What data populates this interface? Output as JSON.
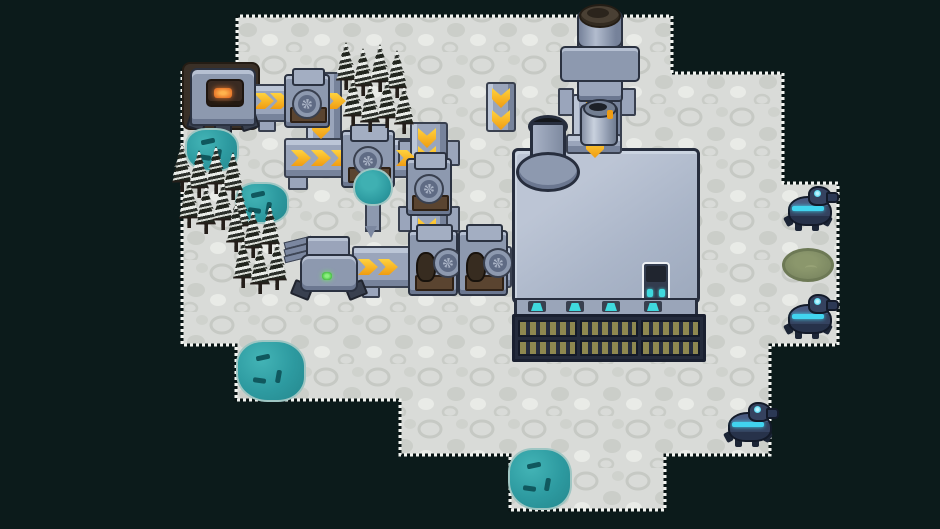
{
  "meta": {
    "scene": "top-down pixel-art factory colony on snowy rock island",
    "resolution": "940x529"
  },
  "palette": {
    "bg": "#0c1b1b",
    "ground": "#d9dbd8",
    "ground_stone": "#c6c9c4",
    "belt": "#9aa5bb",
    "belt_light": "#bcc6d7",
    "belt_shadow": "#77839b",
    "belt_dark": "#39404f",
    "arrow": "#f09c12",
    "arrow_light": "#ffd23e",
    "machine": "#8d99af",
    "machine_light": "#b6c0d2",
    "machine_dark": "#2b3241",
    "mount": "#5a4430",
    "mount_dark": "#2f2115",
    "fire": "#e8772a",
    "fire_light": "#ffb34d",
    "ore": "#2d9aa0",
    "ore_dark": "#10585e",
    "tree": "#22261f",
    "snow": "#e9ece8",
    "roof": "#aab5c8",
    "roof_dark": "#272e3e",
    "strip": "#9aa5b9",
    "slat": "#8e8850",
    "frame": "#242b3c",
    "teal": "#3fd9de",
    "robot": "#35425f",
    "robot_accent": "#41d4ef",
    "pond": "#7c8862",
    "pond_dark": "#6d7955",
    "dirt": "#3a3027",
    "dirt_dark": "#241c14"
  },
  "terrain": {
    "path": "M237,16 H672 V73 H783 V183 H838 V345 H770 V455 H665 V510 H510 V455 H400 V400 H236 V345 H182 V70 H237 Z"
  },
  "dirt_patches": [
    {
      "x": 182,
      "y": 62,
      "w": 78,
      "h": 68
    }
  ],
  "belts": [
    {
      "x": 248,
      "y": 84,
      "w": 94,
      "h": 38,
      "dir": "h"
    },
    {
      "x": 306,
      "y": 72,
      "w": 36,
      "h": 70,
      "dir": "v"
    },
    {
      "x": 284,
      "y": 138,
      "w": 132,
      "h": 40,
      "dir": "h"
    },
    {
      "x": 410,
      "y": 122,
      "w": 38,
      "h": 120,
      "dir": "v"
    },
    {
      "x": 352,
      "y": 246,
      "w": 160,
      "h": 42,
      "dir": "h"
    },
    {
      "x": 486,
      "y": 82,
      "w": 30,
      "h": 50,
      "dir": "v"
    },
    {
      "x": 572,
      "y": 94,
      "w": 50,
      "h": 62,
      "dir": "v"
    }
  ],
  "belt_stubs": [
    {
      "x": 258,
      "y": 120,
      "w": 18,
      "h": 12
    },
    {
      "x": 288,
      "y": 176,
      "w": 20,
      "h": 14
    },
    {
      "x": 398,
      "y": 140,
      "w": 14,
      "h": 26
    },
    {
      "x": 446,
      "y": 140,
      "w": 14,
      "h": 26
    },
    {
      "x": 398,
      "y": 206,
      "w": 14,
      "h": 26
    },
    {
      "x": 446,
      "y": 206,
      "w": 14,
      "h": 26
    },
    {
      "x": 558,
      "y": 88,
      "w": 16,
      "h": 28
    },
    {
      "x": 620,
      "y": 88,
      "w": 16,
      "h": 28
    },
    {
      "x": 362,
      "y": 286,
      "w": 18,
      "h": 12
    }
  ],
  "belt_arrows": [
    {
      "x": 254,
      "y": 93,
      "dir": "right"
    },
    {
      "x": 270,
      "y": 93,
      "dir": "right"
    },
    {
      "x": 326,
      "y": 93,
      "dir": "right"
    },
    {
      "x": 291,
      "y": 150,
      "dir": "right"
    },
    {
      "x": 311,
      "y": 150,
      "dir": "right"
    },
    {
      "x": 331,
      "y": 150,
      "dir": "right"
    },
    {
      "x": 396,
      "y": 150,
      "dir": "right"
    },
    {
      "x": 358,
      "y": 259,
      "dir": "right"
    },
    {
      "x": 378,
      "y": 259,
      "dir": "right"
    },
    {
      "x": 452,
      "y": 261,
      "dir": "right"
    },
    {
      "x": 312,
      "y": 77,
      "dir": "down"
    },
    {
      "x": 312,
      "y": 119,
      "dir": "down"
    },
    {
      "x": 418,
      "y": 128,
      "dir": "down"
    },
    {
      "x": 418,
      "y": 146,
      "dir": "down"
    },
    {
      "x": 418,
      "y": 218,
      "dir": "down"
    },
    {
      "x": 492,
      "y": 88,
      "dir": "down"
    },
    {
      "x": 492,
      "y": 110,
      "dir": "down"
    },
    {
      "x": 586,
      "y": 94,
      "dir": "down"
    }
  ],
  "machines": [
    {
      "x": 284,
      "y": 74,
      "w": 46,
      "h": 54,
      "kind": "processor"
    },
    {
      "x": 341,
      "y": 130,
      "w": 54,
      "h": 58,
      "kind": "processor"
    },
    {
      "x": 406,
      "y": 158,
      "w": 46,
      "h": 58,
      "kind": "processor"
    },
    {
      "x": 408,
      "y": 230,
      "w": 50,
      "h": 66,
      "kind": "assembler"
    },
    {
      "x": 458,
      "y": 230,
      "w": 50,
      "h": 66,
      "kind": "assembler"
    }
  ],
  "ore_deposits": [
    {
      "x": 185,
      "y": 128,
      "w": 54,
      "h": 44
    },
    {
      "x": 235,
      "y": 182,
      "w": 54,
      "h": 42
    },
    {
      "x": 236,
      "y": 340,
      "w": 70,
      "h": 62
    },
    {
      "x": 508,
      "y": 448,
      "w": 64,
      "h": 62
    }
  ],
  "tree_clusters": [
    {
      "x": 336,
      "y": 44,
      "cols": 4,
      "rows": 2
    },
    {
      "x": 172,
      "y": 146,
      "cols": 4,
      "rows": 2
    },
    {
      "x": 226,
      "y": 206,
      "cols": 3,
      "rows": 2
    }
  ],
  "robots": [
    {
      "x": 784,
      "y": 184
    },
    {
      "x": 784,
      "y": 292
    },
    {
      "x": 724,
      "y": 400
    }
  ],
  "factory": {
    "lights_x": [
      14,
      52,
      88,
      130
    ],
    "window_rows": 2,
    "window_cols": 3
  }
}
